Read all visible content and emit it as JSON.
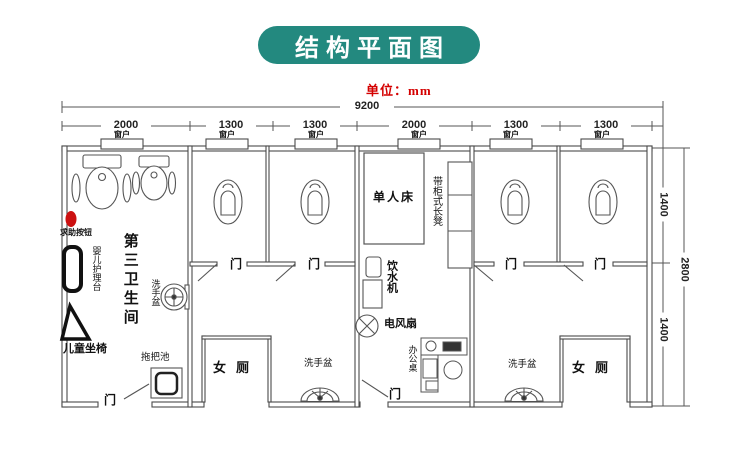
{
  "title": "结构平面图",
  "unit": "单位：mm",
  "colors": {
    "banner": "#23897f",
    "unit_text": "#d40000",
    "line": "#4a4a4a",
    "alert_button": "#cc1111"
  },
  "dims": {
    "total": "9200",
    "segments": [
      "2000",
      "1300",
      "1300",
      "2000",
      "1300",
      "1300"
    ],
    "right_top": "1400",
    "right_bottom": "1400",
    "right_total": "2800"
  },
  "labels": {
    "window": "窗户",
    "door": "门",
    "women_toilet": "女厕",
    "washbasin": "洗手盆",
    "third_restroom": "第三卫生间",
    "help_button": "求助按钮",
    "baby_care": "婴儿护理台",
    "child_seat": "儿童坐椅",
    "mop_sink": "拖把池",
    "single_bed": "单人床",
    "cabinet_bench": "带柜式长凳",
    "water_dispenser": "饮水机",
    "electric_fan": "电风扇",
    "office_desk": "办公桌"
  }
}
